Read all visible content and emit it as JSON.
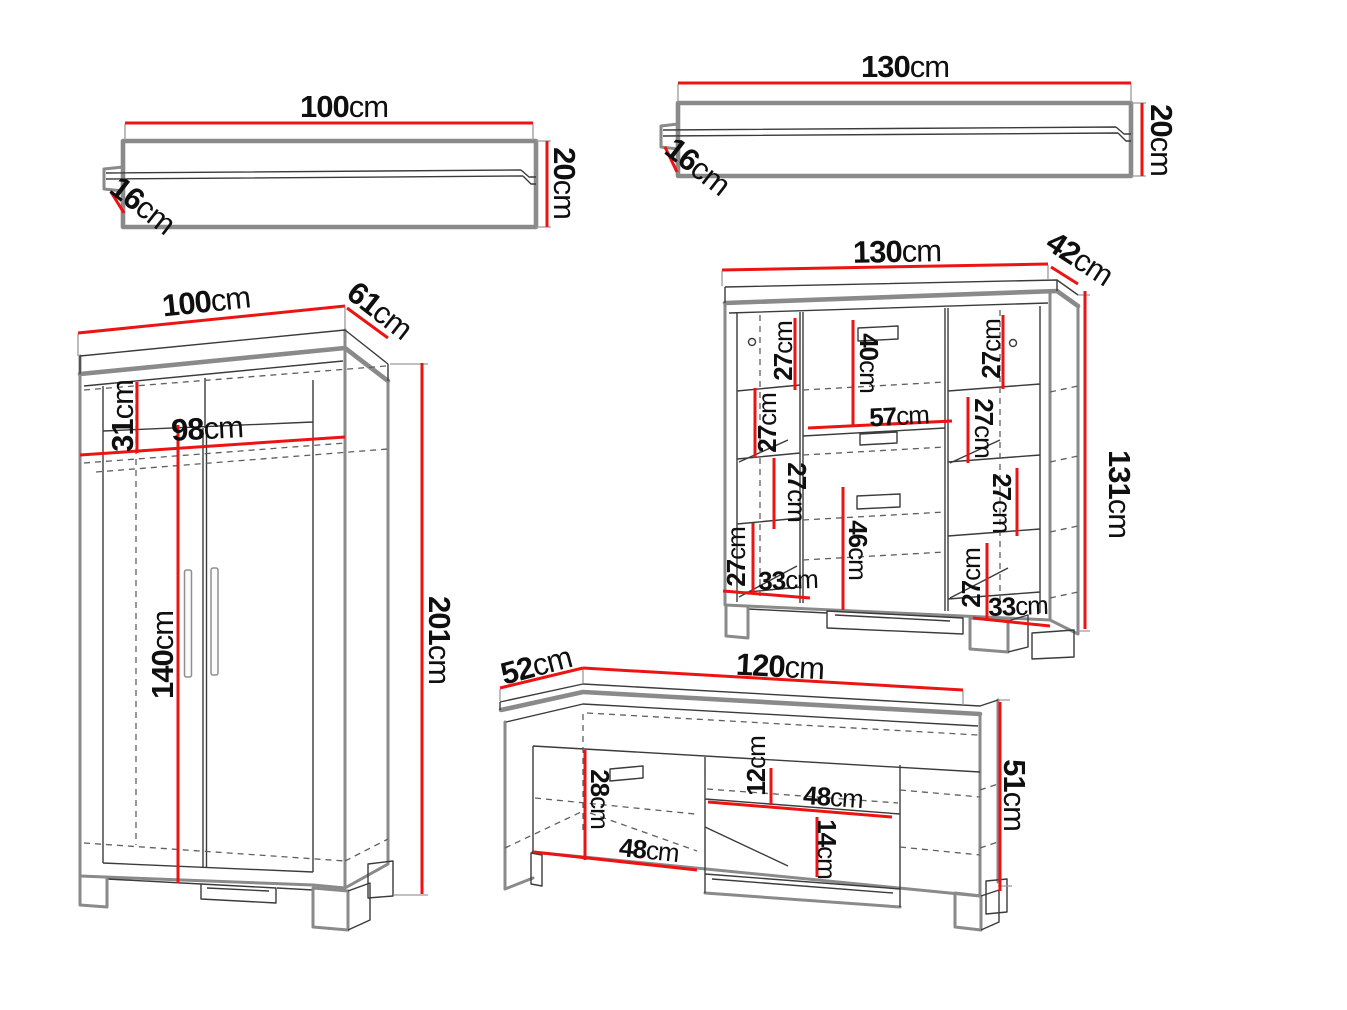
{
  "unit_suffix": "cm",
  "colors": {
    "dimension_red": "#ee1313",
    "outline_gray": "#8a8a8a",
    "line_dark": "#3b3b3b",
    "dash_gray": "#5f5f5f",
    "label_text": "#0f0f0f",
    "background": "#ffffff"
  },
  "pieces": [
    {
      "name": "wall-shelf-small",
      "dims": {
        "width": {
          "value": "100",
          "unit": "cm"
        },
        "height": {
          "value": "20",
          "unit": "cm"
        },
        "depth": {
          "value": "16",
          "unit": "cm"
        }
      }
    },
    {
      "name": "wall-shelf-large",
      "dims": {
        "width": {
          "value": "130",
          "unit": "cm"
        },
        "height": {
          "value": "20",
          "unit": "cm"
        },
        "depth": {
          "value": "16",
          "unit": "cm"
        }
      }
    },
    {
      "name": "wardrobe",
      "dims": {
        "width": {
          "value": "100",
          "unit": "cm"
        },
        "depth": {
          "value": "61",
          "unit": "cm"
        },
        "height": {
          "value": "201",
          "unit": "cm"
        },
        "top_compartment_height": {
          "value": "31",
          "unit": "cm"
        },
        "interior_width": {
          "value": "98",
          "unit": "cm"
        },
        "door_height": {
          "value": "140",
          "unit": "cm"
        }
      }
    },
    {
      "name": "sideboard",
      "dims": {
        "width": {
          "value": "130",
          "unit": "cm"
        },
        "depth": {
          "value": "42",
          "unit": "cm"
        },
        "height": {
          "value": "131",
          "unit": "cm"
        },
        "center_top_height": {
          "value": "40",
          "unit": "cm"
        },
        "center_width": {
          "value": "57",
          "unit": "cm"
        },
        "center_bottom_height": {
          "value": "46",
          "unit": "cm"
        },
        "left_shelf_1": {
          "value": "27",
          "unit": "cm"
        },
        "left_shelf_2": {
          "value": "27",
          "unit": "cm"
        },
        "left_shelf_3": {
          "value": "27",
          "unit": "cm"
        },
        "left_shelf_4": {
          "value": "27",
          "unit": "cm"
        },
        "left_interior_width": {
          "value": "33",
          "unit": "cm"
        },
        "right_shelf_1": {
          "value": "27",
          "unit": "cm"
        },
        "right_shelf_2": {
          "value": "27",
          "unit": "cm"
        },
        "right_shelf_3": {
          "value": "27",
          "unit": "cm"
        },
        "right_shelf_4": {
          "value": "27",
          "unit": "cm"
        },
        "right_interior_width": {
          "value": "33",
          "unit": "cm"
        }
      }
    },
    {
      "name": "tv-stand",
      "dims": {
        "depth": {
          "value": "52",
          "unit": "cm"
        },
        "width": {
          "value": "120",
          "unit": "cm"
        },
        "height": {
          "value": "51",
          "unit": "cm"
        },
        "left_door_height": {
          "value": "28",
          "unit": "cm"
        },
        "left_interior_width": {
          "value": "48",
          "unit": "cm"
        },
        "shelf_top_gap": {
          "value": "12",
          "unit": "cm"
        },
        "shelf_width": {
          "value": "48",
          "unit": "cm"
        },
        "shelf_bottom_gap": {
          "value": "14",
          "unit": "cm"
        }
      }
    }
  ]
}
